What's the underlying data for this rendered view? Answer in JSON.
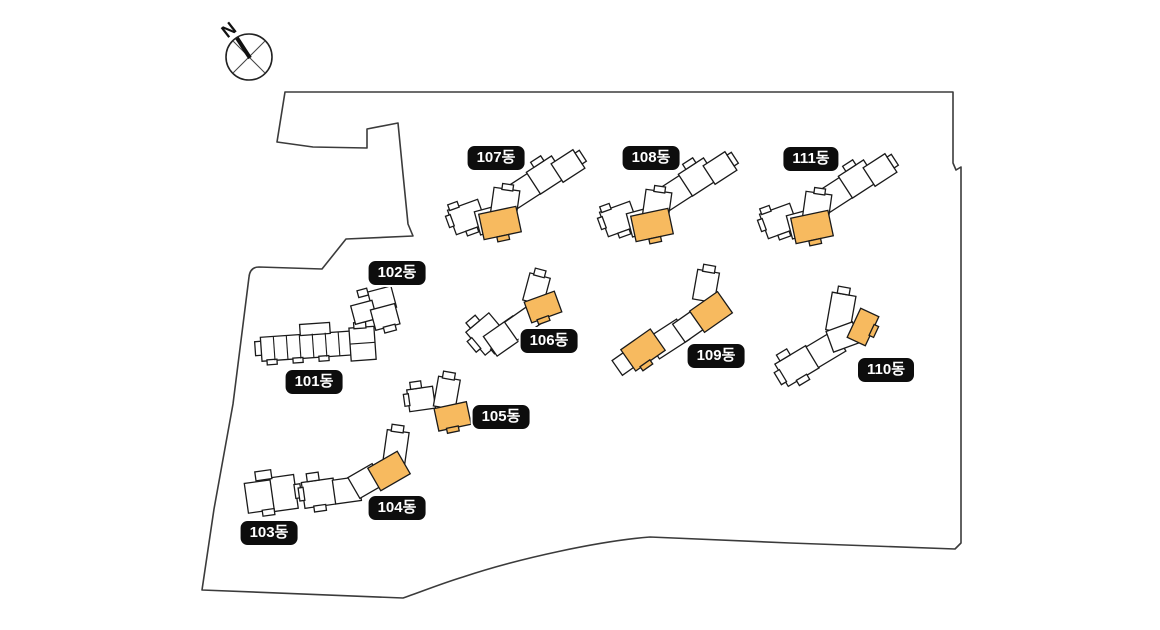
{
  "title": "apartment-complex-site-plan",
  "compass": {
    "north_label": "N"
  },
  "colors": {
    "highlight": "#F7BA5F",
    "building_outline": "#1A1A1A",
    "building_fill": "#FFFFFF",
    "boundary": "#3B3B3B",
    "badge_bg": "#0D0D0D",
    "badge_text": "#FFFFFF"
  },
  "buildings": [
    {
      "id": "101",
      "label": "101동",
      "highlighted_units": 0
    },
    {
      "id": "102",
      "label": "102동",
      "highlighted_units": 0
    },
    {
      "id": "103",
      "label": "103동",
      "highlighted_units": 0
    },
    {
      "id": "104",
      "label": "104동",
      "highlighted_units": 1
    },
    {
      "id": "105",
      "label": "105동",
      "highlighted_units": 1
    },
    {
      "id": "106",
      "label": "106동",
      "highlighted_units": 1
    },
    {
      "id": "107",
      "label": "107동",
      "highlighted_units": 1
    },
    {
      "id": "108",
      "label": "108동",
      "highlighted_units": 1
    },
    {
      "id": "109",
      "label": "109동",
      "highlighted_units": 2
    },
    {
      "id": "110",
      "label": "110동",
      "highlighted_units": 1
    },
    {
      "id": "111",
      "label": "111동",
      "highlighted_units": 1
    }
  ]
}
